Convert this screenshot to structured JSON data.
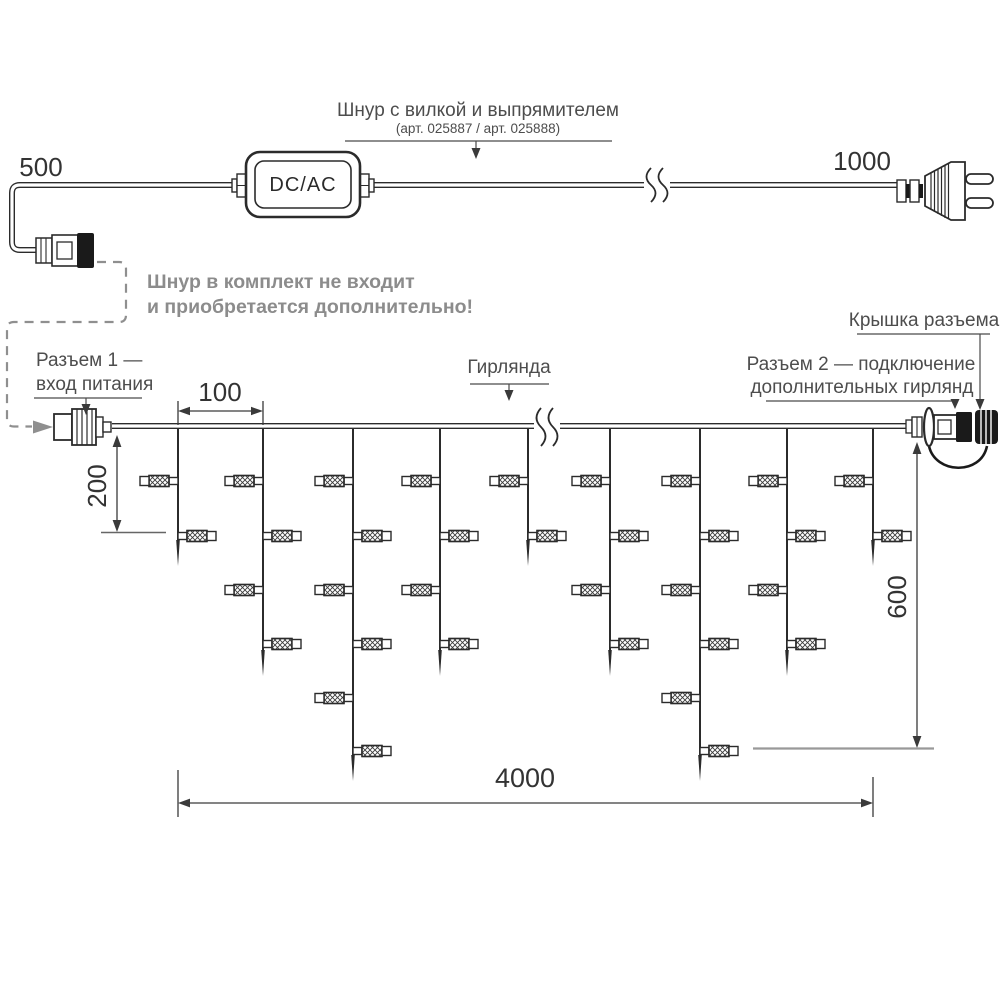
{
  "cord": {
    "label": "Шнур с вилкой и выпрямителем",
    "sublabel": "(арт. 025887 / арт. 025888)",
    "adapter": "DC/AC",
    "left_length": "500",
    "right_length": "1000"
  },
  "note": {
    "line1": "Шнур в комплект не входит",
    "line2": "и приобретается дополнительно!"
  },
  "labels": {
    "connector1_l1": "Разъем 1 —",
    "connector1_l2": "вход питания",
    "garland": "Гирлянда",
    "connector2_l1": "Разъем 2 — подключение",
    "connector2_l2": "дополнительных гирлянд",
    "cap": "Крышка разъема"
  },
  "dimensions": {
    "spacing": "100",
    "short_drop": "200",
    "long_drop": "600",
    "total": "4000"
  },
  "garland": {
    "drops": [
      2,
      4,
      6,
      4,
      2,
      4,
      6,
      4,
      2
    ]
  },
  "colors": {
    "line": "#2b2b2b",
    "gray": "#8f8f8f",
    "note": "#8c8c8c",
    "label": "#4d4d4d",
    "dim": "#333333",
    "leader": "#4a4a4a",
    "ref_gray": "#999999"
  }
}
